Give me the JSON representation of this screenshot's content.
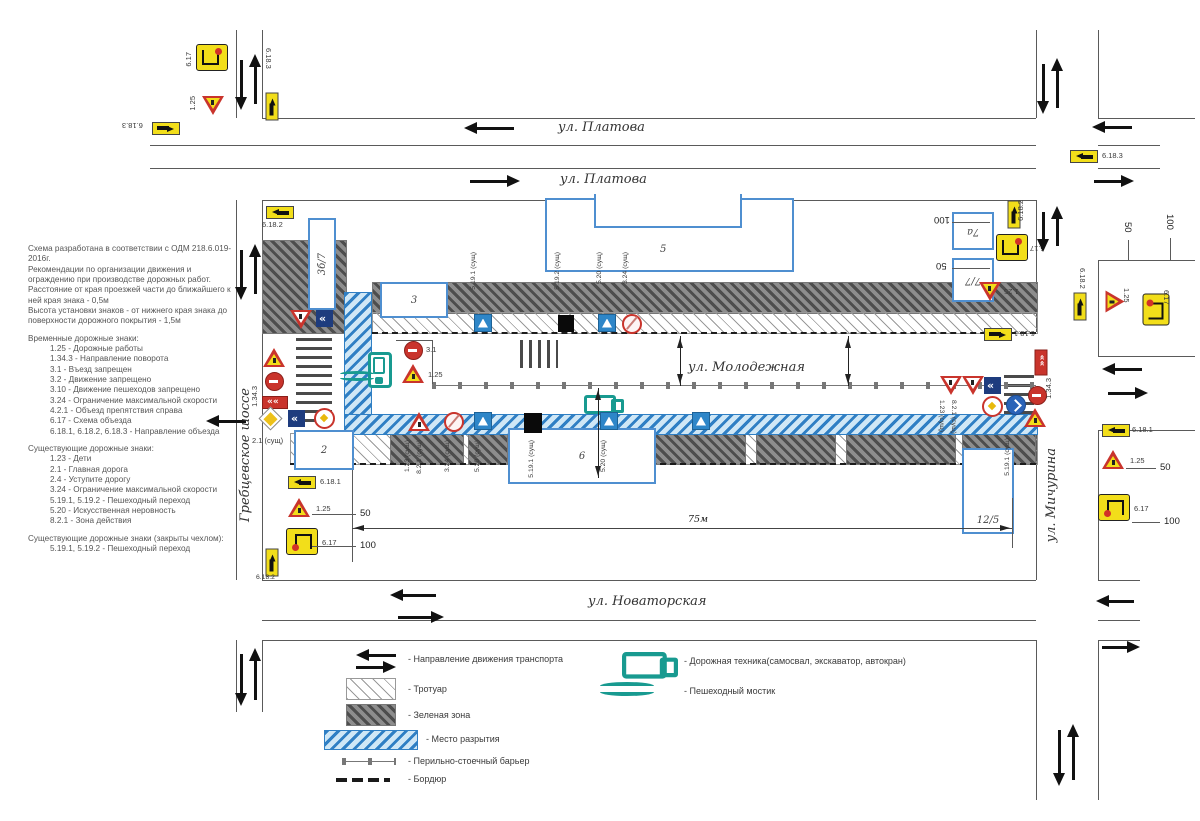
{
  "notes": {
    "intro": [
      "Схема разработана в соответствии с ОДМ 218.6.019-2016г.",
      "Рекомендации по организации движения и ограждению при производстве дорожных работ.",
      "Расстояние от края проезжей части до ближайшего к ней края знака - 0,5м",
      "Высота установки знаков - от нижнего края знака до поверхности дорожного покрытия - 1,5м"
    ],
    "temp_header": "Временные дорожные знаки:",
    "temp_items": [
      "1.25 - Дорожные работы",
      "1.34.3 - Направление поворота",
      "3.1 - Въезд запрещен",
      "3.2 - Движение запрещено",
      "3.10 - Движение пешеходов запрещено",
      "3.24 - Ограничение максимальной скорости",
      "4.2.1 - Объезд препятствия справа",
      "6.17 - Схема объезда",
      "6.18.1, 6.18.2, 6.18.3 - Направление объезда"
    ],
    "exist_header": "Существующие дорожные знаки:",
    "exist_items": [
      "1.23 - Дети",
      "2.1 - Главная дорога",
      "2.4 - Уступите дорогу",
      "3.24 - Ограничение максимальной скорости",
      "5.19.1, 5.19.2 - Пешеходный переход",
      "5.20 - Искусственная неровность",
      "8.2.1 - Зона действия"
    ],
    "covered_header": "Существующие дорожные знаки (закрыты чехлом):",
    "covered_items": [
      "5.19.1, 5.19.2 - Пешеходный переход"
    ]
  },
  "streets": {
    "platova": "ул. Платова",
    "molodezhnaya": "ул. Молодежная",
    "novatorskaya": "ул. Новаторская",
    "grebtsevskoe": "Гребцевское шоссе",
    "michurina": "ул. Мичурина"
  },
  "signs": {
    "s617": "6.17",
    "s125": "1.25",
    "s6181": "6.18.1",
    "s6182": "6.18.2",
    "s6183": "6.18.3",
    "s31": "3.1",
    "s1343": "1.34.3",
    "s21s": "2.1 (сущ)",
    "s123s": "1.23 (сущ)",
    "s821s": "8.2.1 (сущ)",
    "s324s": "3.24 (сущ)",
    "s520s": "5.20 (сущ)",
    "s5191s": "5.19.1 (сущ)",
    "s5192s": "5.19.2 (сущ)"
  },
  "buildings": {
    "b2": "2",
    "b3": "3",
    "b5": "5",
    "b6": "6",
    "b7a": "7а",
    "b77": "7/7",
    "b125": "12/5",
    "b367": "3б/7"
  },
  "dims": {
    "d50": "50",
    "d100": "100",
    "d75": "75м"
  },
  "legend": {
    "left": [
      {
        "icon": "direction-arrows",
        "label": "- Направление движения транспорта"
      },
      {
        "icon": "sidewalk-hatch",
        "label": "- Тротуар"
      },
      {
        "icon": "green-zone-hatch",
        "label": "- Зеленая зона"
      },
      {
        "icon": "excavation-hatch",
        "label": "- Место разрытия"
      },
      {
        "icon": "post-barrier",
        "label": "- Перильно-стоечный барьер"
      },
      {
        "icon": "curb",
        "label": "- Бордюр"
      }
    ],
    "right": [
      {
        "icon": "road-machinery",
        "label": "- Дорожная техника(самосвал, экскаватор, автокран)"
      },
      {
        "icon": "pedestrian-bridge",
        "label": "- Пешеходный мостик"
      }
    ]
  }
}
